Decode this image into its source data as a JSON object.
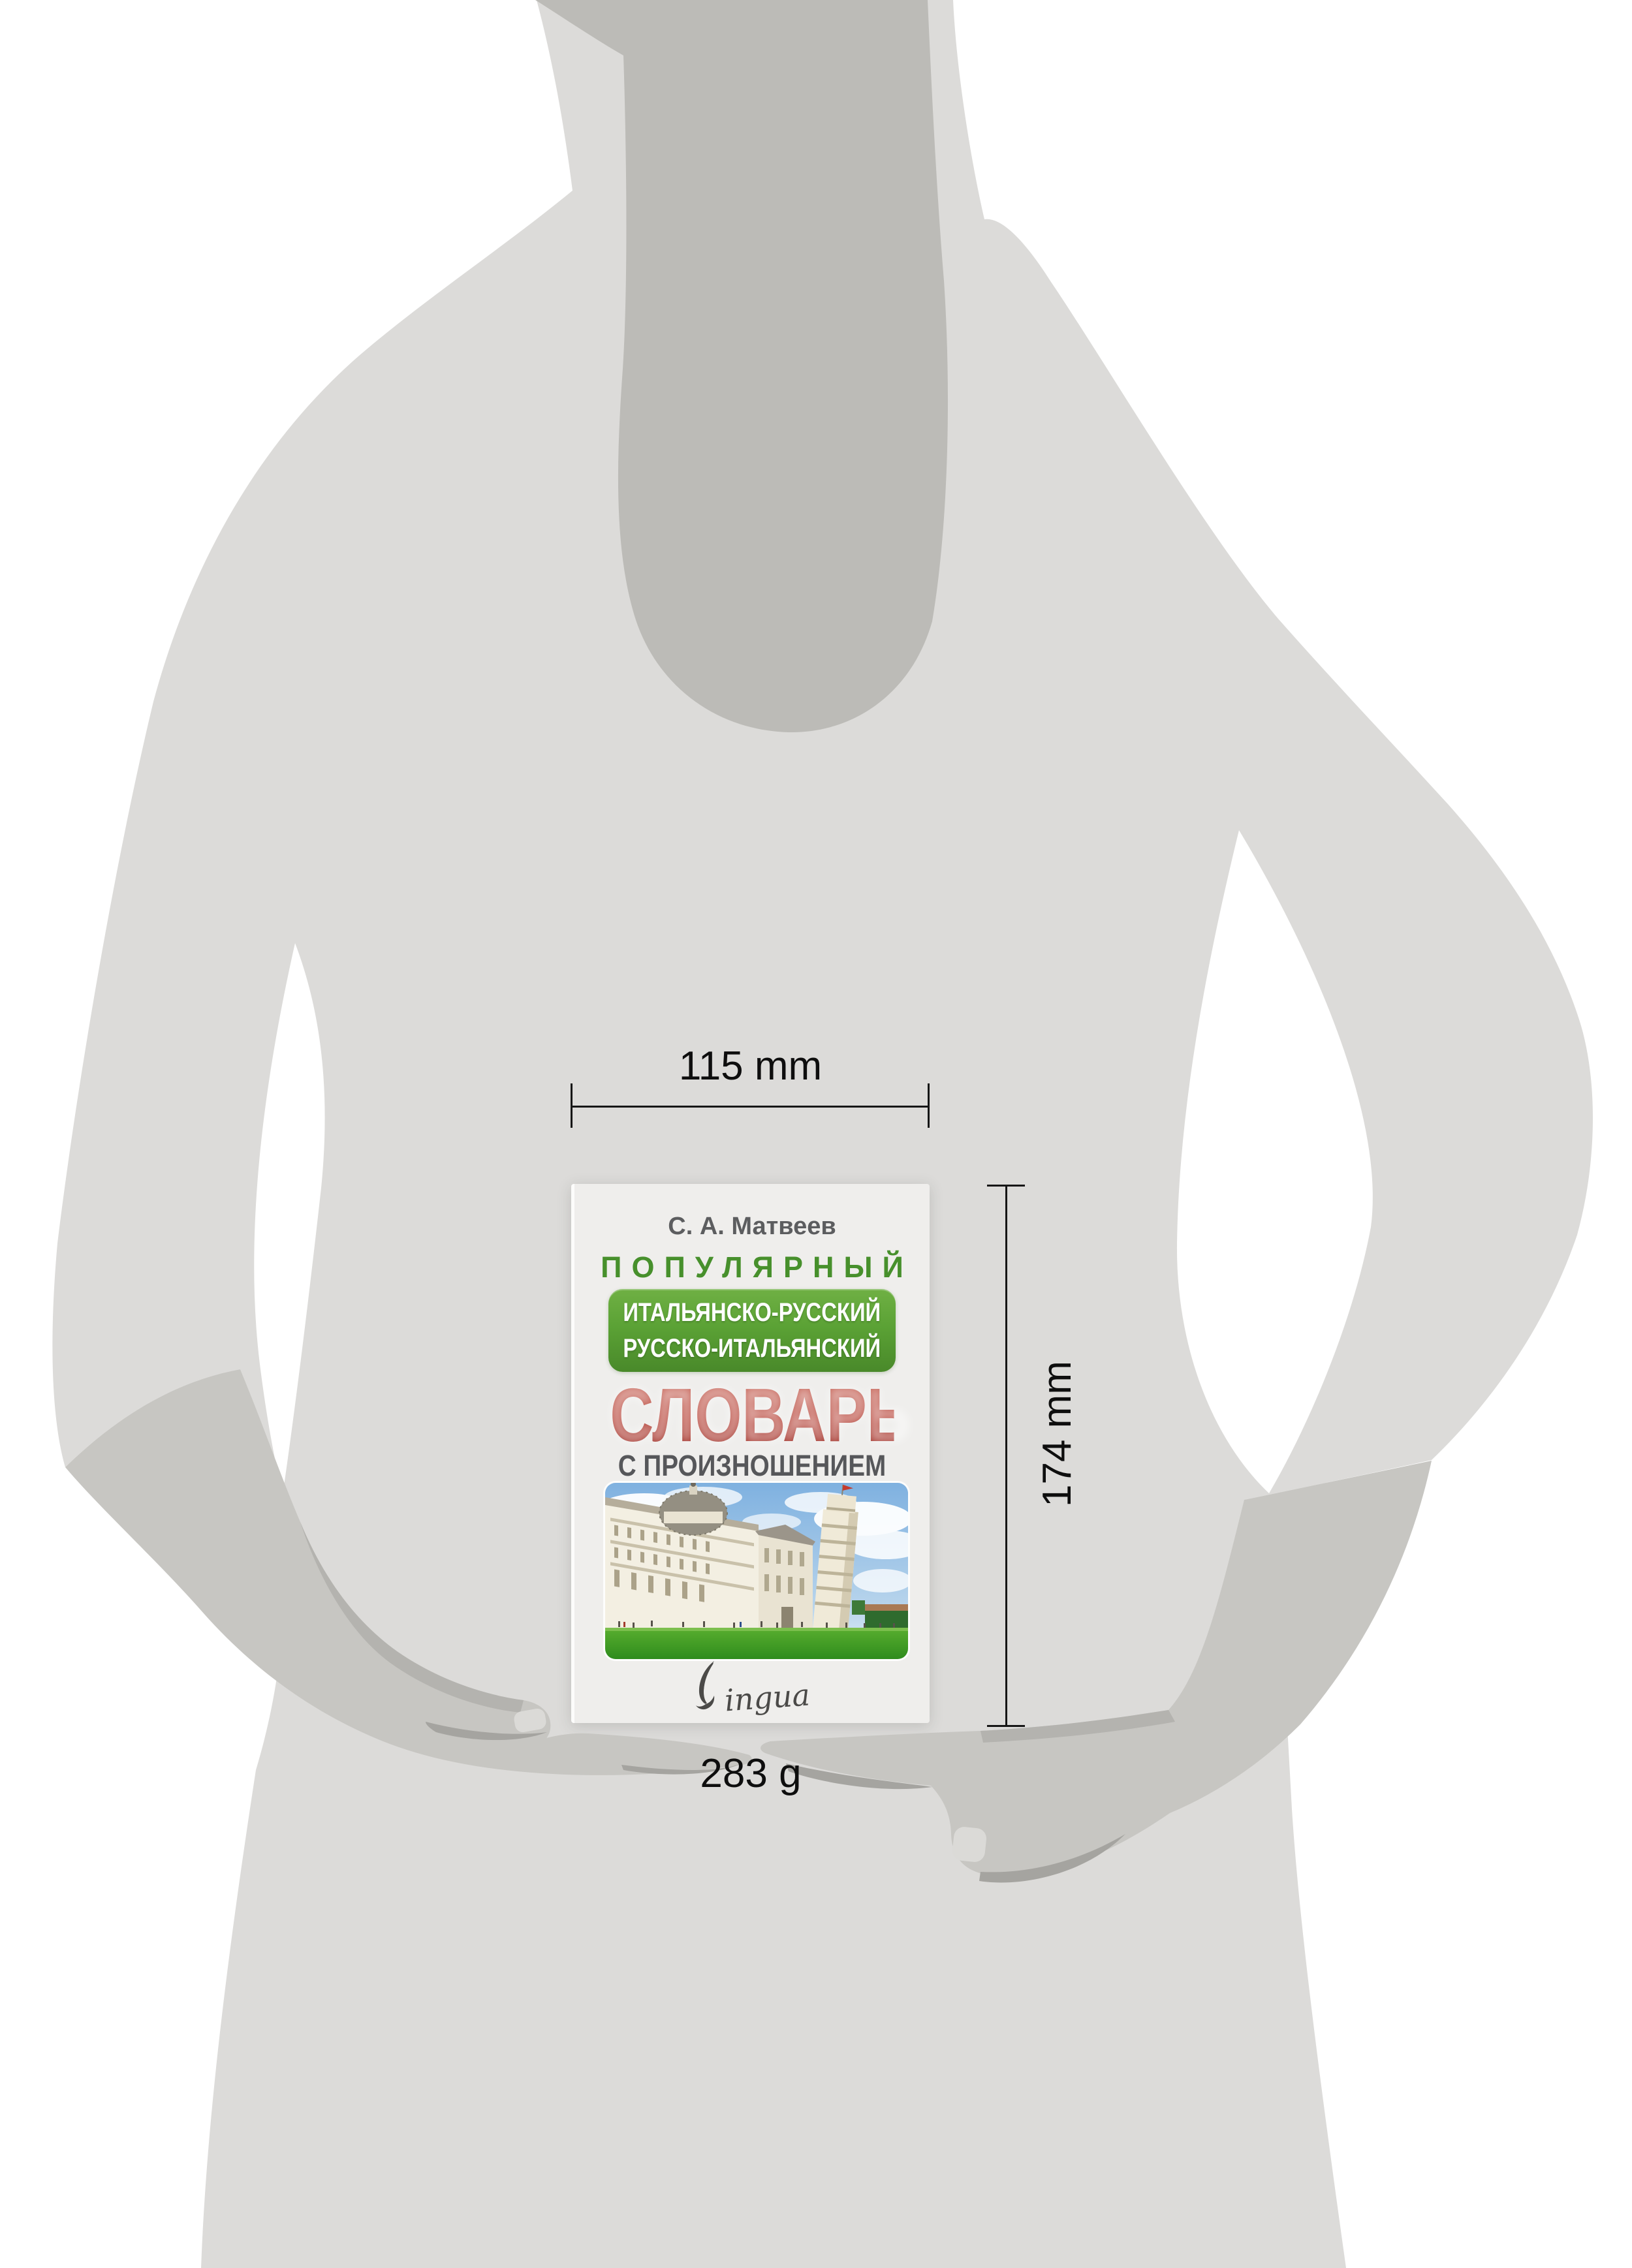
{
  "product_viz": {
    "width_label": "115 mm",
    "height_label": "174 mm",
    "weight_label": "283 g"
  },
  "book_cover": {
    "author": "С. А. Матвеев",
    "series": "ПОПУЛЯРНЫЙ",
    "badge_line1": "ИТАЛЬЯНСКО-РУССКИЙ",
    "badge_line2": "РУССКО-ИТАЛЬЯНСКИЙ",
    "title": "СЛОВАРЬ",
    "subtitle": "С ПРОИЗНОШЕНИЕМ",
    "publisher": "Lingua",
    "publisher_logo_rest": "ingua"
  },
  "icons": {
    "quill_icon": "quill-feather forming the L of Lingua"
  },
  "colors": {
    "series_green": "#47902c",
    "badge_green_top": "#6fb044",
    "badge_green_bottom": "#49892a",
    "title_red_top": "#cb6f62",
    "title_red_bottom": "#992821",
    "cover_background": "#efeeec",
    "silhouette_body": "#dcdbd9",
    "silhouette_neck": "#bcbbb7",
    "silhouette_hands": "#c7c6c2",
    "annotation_ink": "#161616"
  }
}
